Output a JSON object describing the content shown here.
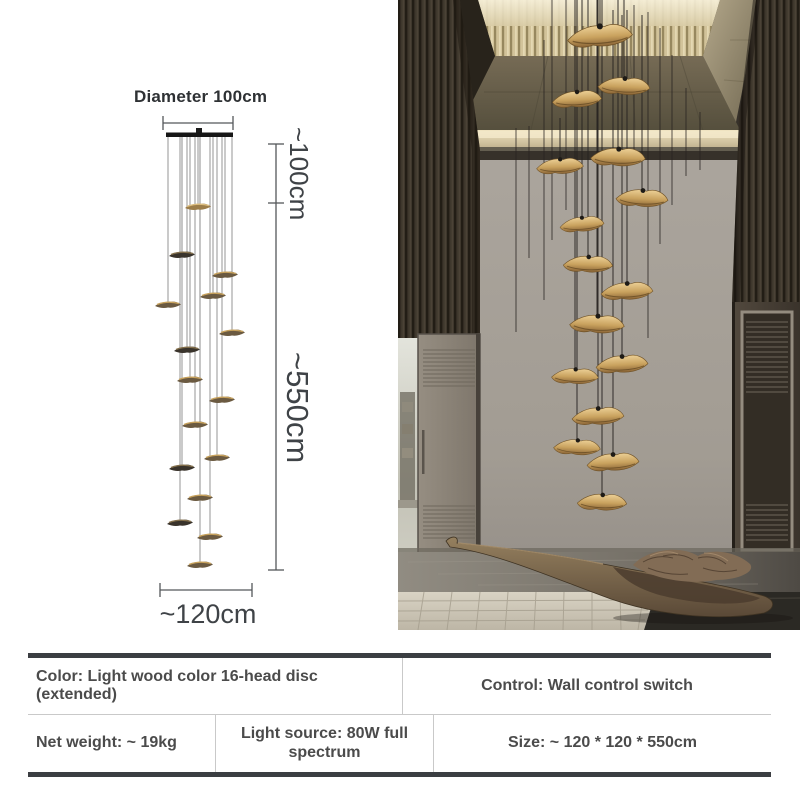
{
  "product_diagram": {
    "diameter_label": "Diameter 100cm",
    "drop_height_label": "~100cm",
    "fixture_height_label": "~550cm",
    "bottom_width_label": "~120cm"
  },
  "spec_table": {
    "color": "Color: Light wood color 16-head disc (extended)",
    "control": "Control: Wall control switch",
    "net_weight": "Net weight: ~ 19kg",
    "light_source": "Light source: 80W full spectrum",
    "size": "Size: ~ 120 * 120 * 550cm"
  },
  "colors": {
    "disc_gold": "#c9a25e",
    "disc_shadow": "#8a6436",
    "table_border": "#3b3e42",
    "table_divider": "#c9c9c9",
    "text_dark": "#4b4b4b",
    "wall_gray": "#a8a29b",
    "cove_light": "#ecdfbd"
  }
}
